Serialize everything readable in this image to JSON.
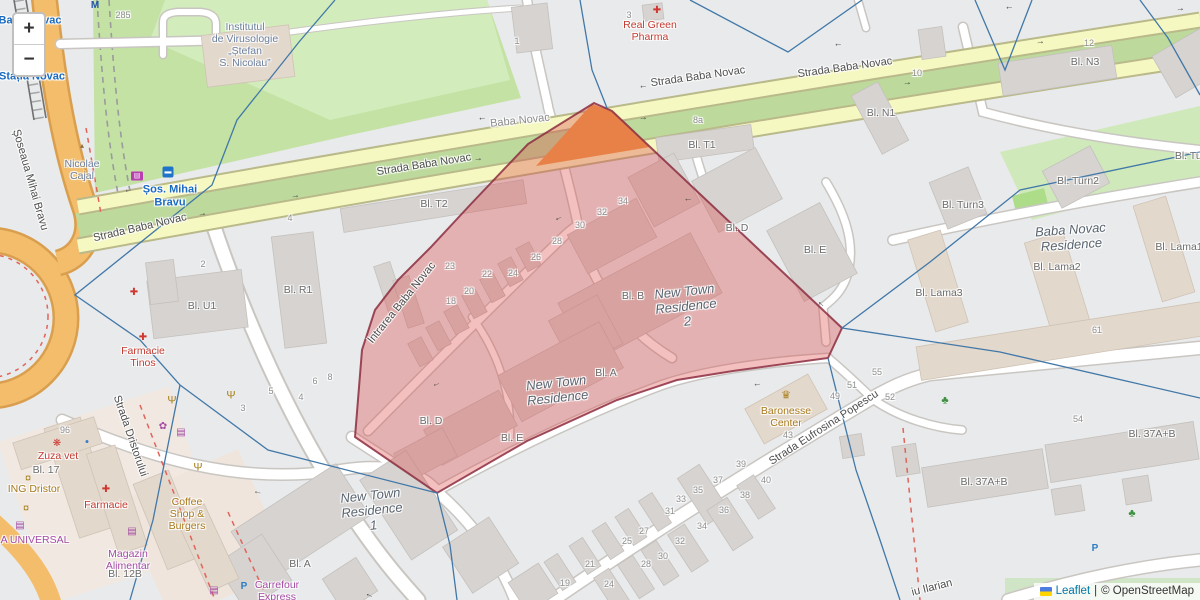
{
  "controls": {
    "zoom_in": "+",
    "zoom_out": "−"
  },
  "attribution": {
    "leaflet": "Leaflet",
    "separator": "|",
    "osm": "© OpenStreetMap"
  },
  "colors": {
    "highlight_fill": "#dd4444",
    "highlight_outline": "#8c2d3f",
    "boundary_line": "#4178a8",
    "main_road": "#f6f8c2",
    "secondary_road": "#f3bd6b",
    "park_green": "#c3e2a4"
  },
  "labels": [
    {
      "name": "street-strada-baba-novac-left",
      "text": "Strada Baba Novac",
      "x": 140,
      "y": 228,
      "cls": "street",
      "rot": -13
    },
    {
      "name": "street-strada-baba-novac-mid",
      "text": "Strada Baba Novac",
      "x": 424,
      "y": 165,
      "cls": "street",
      "rot": -9
    },
    {
      "name": "street-strada-baba-novac-up1",
      "text": "Strada Baba Novac",
      "x": 698,
      "y": 77,
      "cls": "street",
      "rot": -8
    },
    {
      "name": "street-strada-baba-novac-up2",
      "text": "Strada Baba Novac",
      "x": 845,
      "y": 68,
      "cls": "street",
      "rot": -8
    },
    {
      "name": "street-baba-novac-minor",
      "text": "Baba Novac",
      "x": 520,
      "y": 121,
      "cls": "minorname",
      "rot": -6
    },
    {
      "name": "street-intrarea-baba-novac",
      "text": "Intrarea Baba Novac",
      "x": 402,
      "y": 303,
      "cls": "street",
      "rot": -51
    },
    {
      "name": "street-strada-dristorului",
      "text": "Strada Dristorului",
      "x": 130,
      "y": 436,
      "cls": "street",
      "rot": 71
    },
    {
      "name": "street-strada-eufrosina-popescu",
      "text": "Strada Eufrosina Popescu",
      "x": 824,
      "y": 428,
      "cls": "street",
      "rot": -33
    },
    {
      "name": "street-iu-ilarian",
      "text": "iu Ilarian",
      "x": 932,
      "y": 588,
      "cls": "street",
      "rot": -14
    },
    {
      "name": "street-soseaua-mihai-bravu",
      "text": "Șoseaua Mihai Bravu",
      "x": 30,
      "y": 180,
      "cls": "street",
      "rot": 74
    },
    {
      "name": "transit-sos-mihai-bravu",
      "text": "Șos. Mihai\nBravu",
      "x": 170,
      "y": 196,
      "cls": "poi-blue",
      "rot": 0
    },
    {
      "name": "transit-baba-novac",
      "text": "Baba Novac",
      "x": 30,
      "y": 21,
      "cls": "poi-blue",
      "rot": 0
    },
    {
      "name": "transit-statia-novac",
      "text": "Stația Novac",
      "x": 32,
      "y": 77,
      "cls": "poi-blue",
      "rot": 0
    },
    {
      "name": "poi-institutul-virusologie",
      "text": "Institutul\nde Virusologie\n„Ștefan\nS. Nicolau”",
      "x": 245,
      "y": 45,
      "cls": "inst",
      "rot": 0
    },
    {
      "name": "poi-nicolae-cajal",
      "text": "Nicolae\nCajal",
      "x": 82,
      "y": 170,
      "cls": "inst",
      "rot": 0
    },
    {
      "name": "poi-real-green-pharma",
      "text": "Real Green\nPharma",
      "x": 650,
      "y": 31,
      "cls": "poi-red",
      "rot": 0
    },
    {
      "name": "poi-farmacie-tinos",
      "text": "Farmacie\nTinos",
      "x": 143,
      "y": 357,
      "cls": "poi-red",
      "rot": 0
    },
    {
      "name": "poi-farmacie",
      "text": "Farmacie",
      "x": 106,
      "y": 505,
      "cls": "poi-red",
      "rot": 0
    },
    {
      "name": "poi-zuza-vet",
      "text": "Zuza vet",
      "x": 58,
      "y": 456,
      "cls": "poi-red",
      "rot": 0
    },
    {
      "name": "poi-ing-dristor",
      "text": "ING Dristor",
      "x": 34,
      "y": 489,
      "cls": "poi-gold",
      "rot": 0
    },
    {
      "name": "poi-coffee-shop-burgers",
      "text": "Coffee\nShop &\nBurgers",
      "x": 187,
      "y": 514,
      "cls": "poi-gold",
      "rot": 0
    },
    {
      "name": "poi-baronesse-center",
      "text": "Baronesse\nCenter",
      "x": 786,
      "y": 417,
      "cls": "poi-gold",
      "rot": 0
    },
    {
      "name": "poi-a-universal",
      "text": "A UNIVERSAL",
      "x": 35,
      "y": 540,
      "cls": "poi-purple",
      "rot": 0
    },
    {
      "name": "poi-magazin-alimentar",
      "text": "Magazin\nAlimentar",
      "x": 128,
      "y": 560,
      "cls": "poi-purple",
      "rot": 0
    },
    {
      "name": "poi-carrefour-express",
      "text": "Carrefour\nExpress",
      "x": 277,
      "y": 591,
      "cls": "poi-purple",
      "rot": 0
    },
    {
      "name": "res-new-town-residence-2",
      "text": "New Town\nResidence\n2",
      "x": 686,
      "y": 307,
      "cls": "res",
      "rot": -6
    },
    {
      "name": "res-new-town-residence",
      "text": "New Town\nResidence",
      "x": 557,
      "y": 391,
      "cls": "res",
      "rot": -6
    },
    {
      "name": "res-new-town-residence-1",
      "text": "New Town\nResidence\n1",
      "x": 372,
      "y": 511,
      "cls": "res",
      "rot": -6
    },
    {
      "name": "res-baba-novac-residence",
      "text": "Baba Novac\nResidence",
      "x": 1071,
      "y": 238,
      "cls": "res",
      "rot": -4
    },
    {
      "name": "bld-t1",
      "text": "Bl. T1",
      "x": 702,
      "y": 145,
      "cls": "bld",
      "rot": 0
    },
    {
      "name": "bld-t2",
      "text": "Bl. T2",
      "x": 434,
      "y": 204,
      "cls": "bld",
      "rot": 0
    },
    {
      "name": "bld-n1",
      "text": "Bl. N1",
      "x": 881,
      "y": 113,
      "cls": "bld",
      "rot": 0
    },
    {
      "name": "bld-n3",
      "text": "Bl. N3",
      "x": 1085,
      "y": 62,
      "cls": "bld",
      "rot": 0
    },
    {
      "name": "bld-tur",
      "text": "Bl. Tur",
      "x": 1190,
      "y": 156,
      "cls": "bld",
      "rot": 0
    },
    {
      "name": "bld-turn2",
      "text": "Bl. Turn2",
      "x": 1078,
      "y": 181,
      "cls": "bld",
      "rot": 0
    },
    {
      "name": "bld-turn3",
      "text": "Bl. Turn3",
      "x": 963,
      "y": 205,
      "cls": "bld",
      "rot": 0
    },
    {
      "name": "bld-lama1",
      "text": "Bl. Lama1",
      "x": 1179,
      "y": 247,
      "cls": "bld",
      "rot": 0
    },
    {
      "name": "bld-lama2",
      "text": "Bl. Lama2",
      "x": 1057,
      "y": 267,
      "cls": "bld",
      "rot": 0
    },
    {
      "name": "bld-lama3",
      "text": "Bl. Lama3",
      "x": 939,
      "y": 293,
      "cls": "bld",
      "rot": 0
    },
    {
      "name": "bld-r1",
      "text": "Bl. R1",
      "x": 298,
      "y": 290,
      "cls": "bld",
      "rot": 0
    },
    {
      "name": "bld-u1",
      "text": "Bl. U1",
      "x": 202,
      "y": 306,
      "cls": "bld",
      "rot": 0
    },
    {
      "name": "bld-17",
      "text": "Bl. 17",
      "x": 46,
      "y": 470,
      "cls": "bld",
      "rot": 0
    },
    {
      "name": "bld-12b",
      "text": "Bl. 12B",
      "x": 125,
      "y": 574,
      "cls": "bld",
      "rot": 0
    },
    {
      "name": "bld-a-sw",
      "text": "Bl. A",
      "x": 300,
      "y": 564,
      "cls": "bld",
      "rot": 0
    },
    {
      "name": "bld-a-mid",
      "text": "Bl. A",
      "x": 606,
      "y": 373,
      "cls": "bld",
      "rot": 0
    },
    {
      "name": "bld-b",
      "text": "Bl. B",
      "x": 633,
      "y": 296,
      "cls": "bld",
      "rot": 0
    },
    {
      "name": "bld-d-east",
      "text": "Bl. D",
      "x": 737,
      "y": 228,
      "cls": "bld",
      "rot": 0
    },
    {
      "name": "bld-d-west",
      "text": "Bl. D",
      "x": 431,
      "y": 421,
      "cls": "bld",
      "rot": 0
    },
    {
      "name": "bld-e-east",
      "text": "Bl. E",
      "x": 815,
      "y": 250,
      "cls": "bld",
      "rot": 0
    },
    {
      "name": "bld-e-west",
      "text": "Bl. E",
      "x": 512,
      "y": 438,
      "cls": "bld",
      "rot": 0
    },
    {
      "name": "bld-37ab-1",
      "text": "Bl. 37A+B",
      "x": 984,
      "y": 482,
      "cls": "bld",
      "rot": 0
    },
    {
      "name": "bld-37ab-2",
      "text": "Bl. 37A+B",
      "x": 1152,
      "y": 434,
      "cls": "bld",
      "rot": 0
    },
    {
      "name": "num-285",
      "text": "285",
      "x": 123,
      "y": 15,
      "cls": "num",
      "rot": 0
    },
    {
      "name": "num-3-top",
      "text": "3",
      "x": 629,
      "y": 15,
      "cls": "num",
      "rot": 0
    },
    {
      "name": "num-1-top",
      "text": "1",
      "x": 517,
      "y": 41,
      "cls": "num",
      "rot": 0
    },
    {
      "name": "num-8a",
      "text": "8a",
      "x": 698,
      "y": 120,
      "cls": "num",
      "rot": 0
    },
    {
      "name": "num-10",
      "text": "10",
      "x": 917,
      "y": 73,
      "cls": "num",
      "rot": 0
    },
    {
      "name": "num-12",
      "text": "12",
      "x": 1089,
      "y": 43,
      "cls": "num",
      "rot": 0
    },
    {
      "name": "num-4-park",
      "text": "4",
      "x": 290,
      "y": 218,
      "cls": "num",
      "rot": 0
    },
    {
      "name": "num-2-u1",
      "text": "2",
      "x": 203,
      "y": 264,
      "cls": "num",
      "rot": 0
    },
    {
      "name": "num-18",
      "text": "18",
      "x": 451,
      "y": 301,
      "cls": "num",
      "rot": 0
    },
    {
      "name": "num-20",
      "text": "20",
      "x": 469,
      "y": 291,
      "cls": "num",
      "rot": 0
    },
    {
      "name": "num-22",
      "text": "22",
      "x": 487,
      "y": 274,
      "cls": "num",
      "rot": 0
    },
    {
      "name": "num-23",
      "text": "23",
      "x": 450,
      "y": 266,
      "cls": "num",
      "rot": 0
    },
    {
      "name": "num-24-poly",
      "text": "24",
      "x": 513,
      "y": 273,
      "cls": "num",
      "rot": 0
    },
    {
      "name": "num-26",
      "text": "26",
      "x": 536,
      "y": 257,
      "cls": "num",
      "rot": 0
    },
    {
      "name": "num-28-poly",
      "text": "28",
      "x": 557,
      "y": 241,
      "cls": "num",
      "rot": 0
    },
    {
      "name": "num-30-poly",
      "text": "30",
      "x": 580,
      "y": 225,
      "cls": "num",
      "rot": 0
    },
    {
      "name": "num-32-poly",
      "text": "32",
      "x": 602,
      "y": 212,
      "cls": "num",
      "rot": 0
    },
    {
      "name": "num-34-poly",
      "text": "34",
      "x": 623,
      "y": 201,
      "cls": "num",
      "rot": 0
    },
    {
      "name": "num-96",
      "text": "96",
      "x": 65,
      "y": 430,
      "cls": "num",
      "rot": 0
    },
    {
      "name": "num-3-s",
      "text": "3",
      "x": 243,
      "y": 408,
      "cls": "num",
      "rot": 0
    },
    {
      "name": "num-5-s",
      "text": "5",
      "x": 271,
      "y": 391,
      "cls": "num",
      "rot": 0
    },
    {
      "name": "num-4-s",
      "text": "4",
      "x": 301,
      "y": 397,
      "cls": "num",
      "rot": 0
    },
    {
      "name": "num-6-s",
      "text": "6",
      "x": 315,
      "y": 381,
      "cls": "num",
      "rot": 0
    },
    {
      "name": "num-8-s",
      "text": "8",
      "x": 330,
      "y": 377,
      "cls": "num",
      "rot": 0
    },
    {
      "name": "num-19",
      "text": "19",
      "x": 565,
      "y": 583,
      "cls": "num",
      "rot": 0
    },
    {
      "name": "num-21",
      "text": "21",
      "x": 590,
      "y": 564,
      "cls": "num",
      "rot": 0
    },
    {
      "name": "num-24-e",
      "text": "24",
      "x": 609,
      "y": 584,
      "cls": "num",
      "rot": 0
    },
    {
      "name": "num-25",
      "text": "25",
      "x": 627,
      "y": 541,
      "cls": "num",
      "rot": 0
    },
    {
      "name": "num-27",
      "text": "27",
      "x": 644,
      "y": 531,
      "cls": "num",
      "rot": 0
    },
    {
      "name": "num-28-e",
      "text": "28",
      "x": 646,
      "y": 564,
      "cls": "num",
      "rot": 0
    },
    {
      "name": "num-30-e",
      "text": "30",
      "x": 663,
      "y": 556,
      "cls": "num",
      "rot": 0
    },
    {
      "name": "num-31",
      "text": "31",
      "x": 670,
      "y": 511,
      "cls": "num",
      "rot": 0
    },
    {
      "name": "num-32-e",
      "text": "32",
      "x": 680,
      "y": 541,
      "cls": "num",
      "rot": 0
    },
    {
      "name": "num-33",
      "text": "33",
      "x": 681,
      "y": 499,
      "cls": "num",
      "rot": 0
    },
    {
      "name": "num-34-e",
      "text": "34",
      "x": 702,
      "y": 526,
      "cls": "num",
      "rot": 0
    },
    {
      "name": "num-35",
      "text": "35",
      "x": 698,
      "y": 490,
      "cls": "num",
      "rot": 0
    },
    {
      "name": "num-36",
      "text": "36",
      "x": 724,
      "y": 510,
      "cls": "num",
      "rot": 0
    },
    {
      "name": "num-37",
      "text": "37",
      "x": 718,
      "y": 480,
      "cls": "num",
      "rot": 0
    },
    {
      "name": "num-38",
      "text": "38",
      "x": 745,
      "y": 495,
      "cls": "num",
      "rot": 0
    },
    {
      "name": "num-39",
      "text": "39",
      "x": 741,
      "y": 464,
      "cls": "num",
      "rot": 0
    },
    {
      "name": "num-40",
      "text": "40",
      "x": 766,
      "y": 480,
      "cls": "num",
      "rot": 0
    },
    {
      "name": "num-43",
      "text": "43",
      "x": 788,
      "y": 435,
      "cls": "num",
      "rot": 0
    },
    {
      "name": "num-49",
      "text": "49",
      "x": 835,
      "y": 396,
      "cls": "num",
      "rot": 0
    },
    {
      "name": "num-51",
      "text": "51",
      "x": 852,
      "y": 385,
      "cls": "num",
      "rot": 0
    },
    {
      "name": "num-52",
      "text": "52",
      "x": 890,
      "y": 397,
      "cls": "num",
      "rot": 0
    },
    {
      "name": "num-54",
      "text": "54",
      "x": 1078,
      "y": 419,
      "cls": "num",
      "rot": 0
    },
    {
      "name": "num-55",
      "text": "55",
      "x": 877,
      "y": 372,
      "cls": "num",
      "rot": 0
    },
    {
      "name": "num-61",
      "text": "61",
      "x": 1097,
      "y": 330,
      "cls": "num",
      "rot": 0
    }
  ],
  "icons": [
    {
      "name": "pharmacy-icon",
      "glyph": "✚",
      "cls": "ic-red",
      "x": 657,
      "y": 11
    },
    {
      "name": "pharmacy-icon",
      "glyph": "✚",
      "cls": "ic-red",
      "x": 143,
      "y": 338
    },
    {
      "name": "pharmacy-icon",
      "glyph": "✚",
      "cls": "ic-red",
      "x": 134,
      "y": 293
    },
    {
      "name": "pharmacy-icon",
      "glyph": "✚",
      "cls": "ic-red",
      "x": 106,
      "y": 490
    },
    {
      "name": "vet-paw-icon",
      "glyph": "❋",
      "cls": "ic-red",
      "x": 57,
      "y": 444
    },
    {
      "name": "bank-icon",
      "glyph": "¤",
      "cls": "ic-gold",
      "x": 28,
      "y": 479
    },
    {
      "name": "bank-icon",
      "glyph": "¤",
      "cls": "ic-gold",
      "x": 26,
      "y": 509
    },
    {
      "name": "shop-basket-icon",
      "glyph": "▤",
      "cls": "ic-purple",
      "x": 20,
      "y": 526
    },
    {
      "name": "shop-basket-icon",
      "glyph": "▤",
      "cls": "ic-purple",
      "x": 132,
      "y": 532
    },
    {
      "name": "shop-basket-icon",
      "glyph": "▤",
      "cls": "ic-purple",
      "x": 214,
      "y": 591
    },
    {
      "name": "florist-icon",
      "glyph": "✿",
      "cls": "ic-purple",
      "x": 163,
      "y": 427
    },
    {
      "name": "shop-icon",
      "glyph": "▤",
      "cls": "ic-purple",
      "x": 181,
      "y": 433
    },
    {
      "name": "restaurant-icon",
      "glyph": "Ψ",
      "cls": "ic-gold",
      "x": 172,
      "y": 401
    },
    {
      "name": "restaurant-icon",
      "glyph": "Ψ",
      "cls": "ic-gold",
      "x": 231,
      "y": 396
    },
    {
      "name": "restaurant-icon",
      "glyph": "Ψ",
      "cls": "ic-gold",
      "x": 198,
      "y": 468
    },
    {
      "name": "crown-icon",
      "glyph": "♛",
      "cls": "ic-gold",
      "x": 786,
      "y": 396
    },
    {
      "name": "monument-icon",
      "glyph": "▴",
      "cls": "ic-brown",
      "x": 82,
      "y": 146
    },
    {
      "name": "tree-icon",
      "glyph": "♣",
      "cls": "ic-green",
      "x": 945,
      "y": 401
    },
    {
      "name": "tree-icon",
      "glyph": "♣",
      "cls": "ic-green",
      "x": 1132,
      "y": 514
    },
    {
      "name": "parking-icon",
      "glyph": "P",
      "cls": "ic-blue",
      "x": 244,
      "y": 587
    },
    {
      "name": "parking-icon",
      "glyph": "P",
      "cls": "ic-blue",
      "x": 1095,
      "y": 549
    },
    {
      "name": "bus-stop-icon",
      "glyph": "▬",
      "cls": "ic-bus",
      "x": 168,
      "y": 172
    },
    {
      "name": "rail-station-icon",
      "glyph": "▤",
      "cls": "ic-rail",
      "x": 137,
      "y": 176
    },
    {
      "name": "metro-icon",
      "glyph": "M",
      "cls": "ic-metro",
      "x": 95,
      "y": 6
    },
    {
      "name": "water-point-icon",
      "glyph": "●",
      "cls": "ic-bluedot",
      "x": 87,
      "y": 442
    }
  ],
  "arrows": [
    {
      "x": 128,
      "y": 189,
      "ch": "←",
      "rot": -14
    },
    {
      "x": 482,
      "y": 117,
      "ch": "←",
      "rot": -9
    },
    {
      "x": 643,
      "y": 85,
      "ch": "←",
      "rot": -8
    },
    {
      "x": 838,
      "y": 43,
      "ch": "←",
      "rot": -8
    },
    {
      "x": 1009,
      "y": 6,
      "ch": "←",
      "rot": -8
    },
    {
      "x": 202,
      "y": 213,
      "ch": "→",
      "rot": -12
    },
    {
      "x": 295,
      "y": 195,
      "ch": "→",
      "rot": -10
    },
    {
      "x": 478,
      "y": 158,
      "ch": "→",
      "rot": -9
    },
    {
      "x": 643,
      "y": 117,
      "ch": "→",
      "rot": -8
    },
    {
      "x": 907,
      "y": 82,
      "ch": "→",
      "rot": -8
    },
    {
      "x": 1040,
      "y": 41,
      "ch": "→",
      "rot": -8
    },
    {
      "x": 1180,
      "y": 8,
      "ch": "→",
      "rot": -8
    },
    {
      "x": 558,
      "y": 217,
      "ch": "←",
      "rot": -25
    },
    {
      "x": 688,
      "y": 198,
      "ch": "←",
      "rot": 0
    },
    {
      "x": 757,
      "y": 383,
      "ch": "←",
      "rot": -10
    },
    {
      "x": 436,
      "y": 383,
      "ch": "←",
      "rot": -20
    },
    {
      "x": 822,
      "y": 303,
      "ch": "←",
      "rot": 40
    },
    {
      "x": 258,
      "y": 491,
      "ch": "←",
      "rot": 12
    },
    {
      "x": 370,
      "y": 594,
      "ch": "←",
      "rot": 25
    }
  ]
}
